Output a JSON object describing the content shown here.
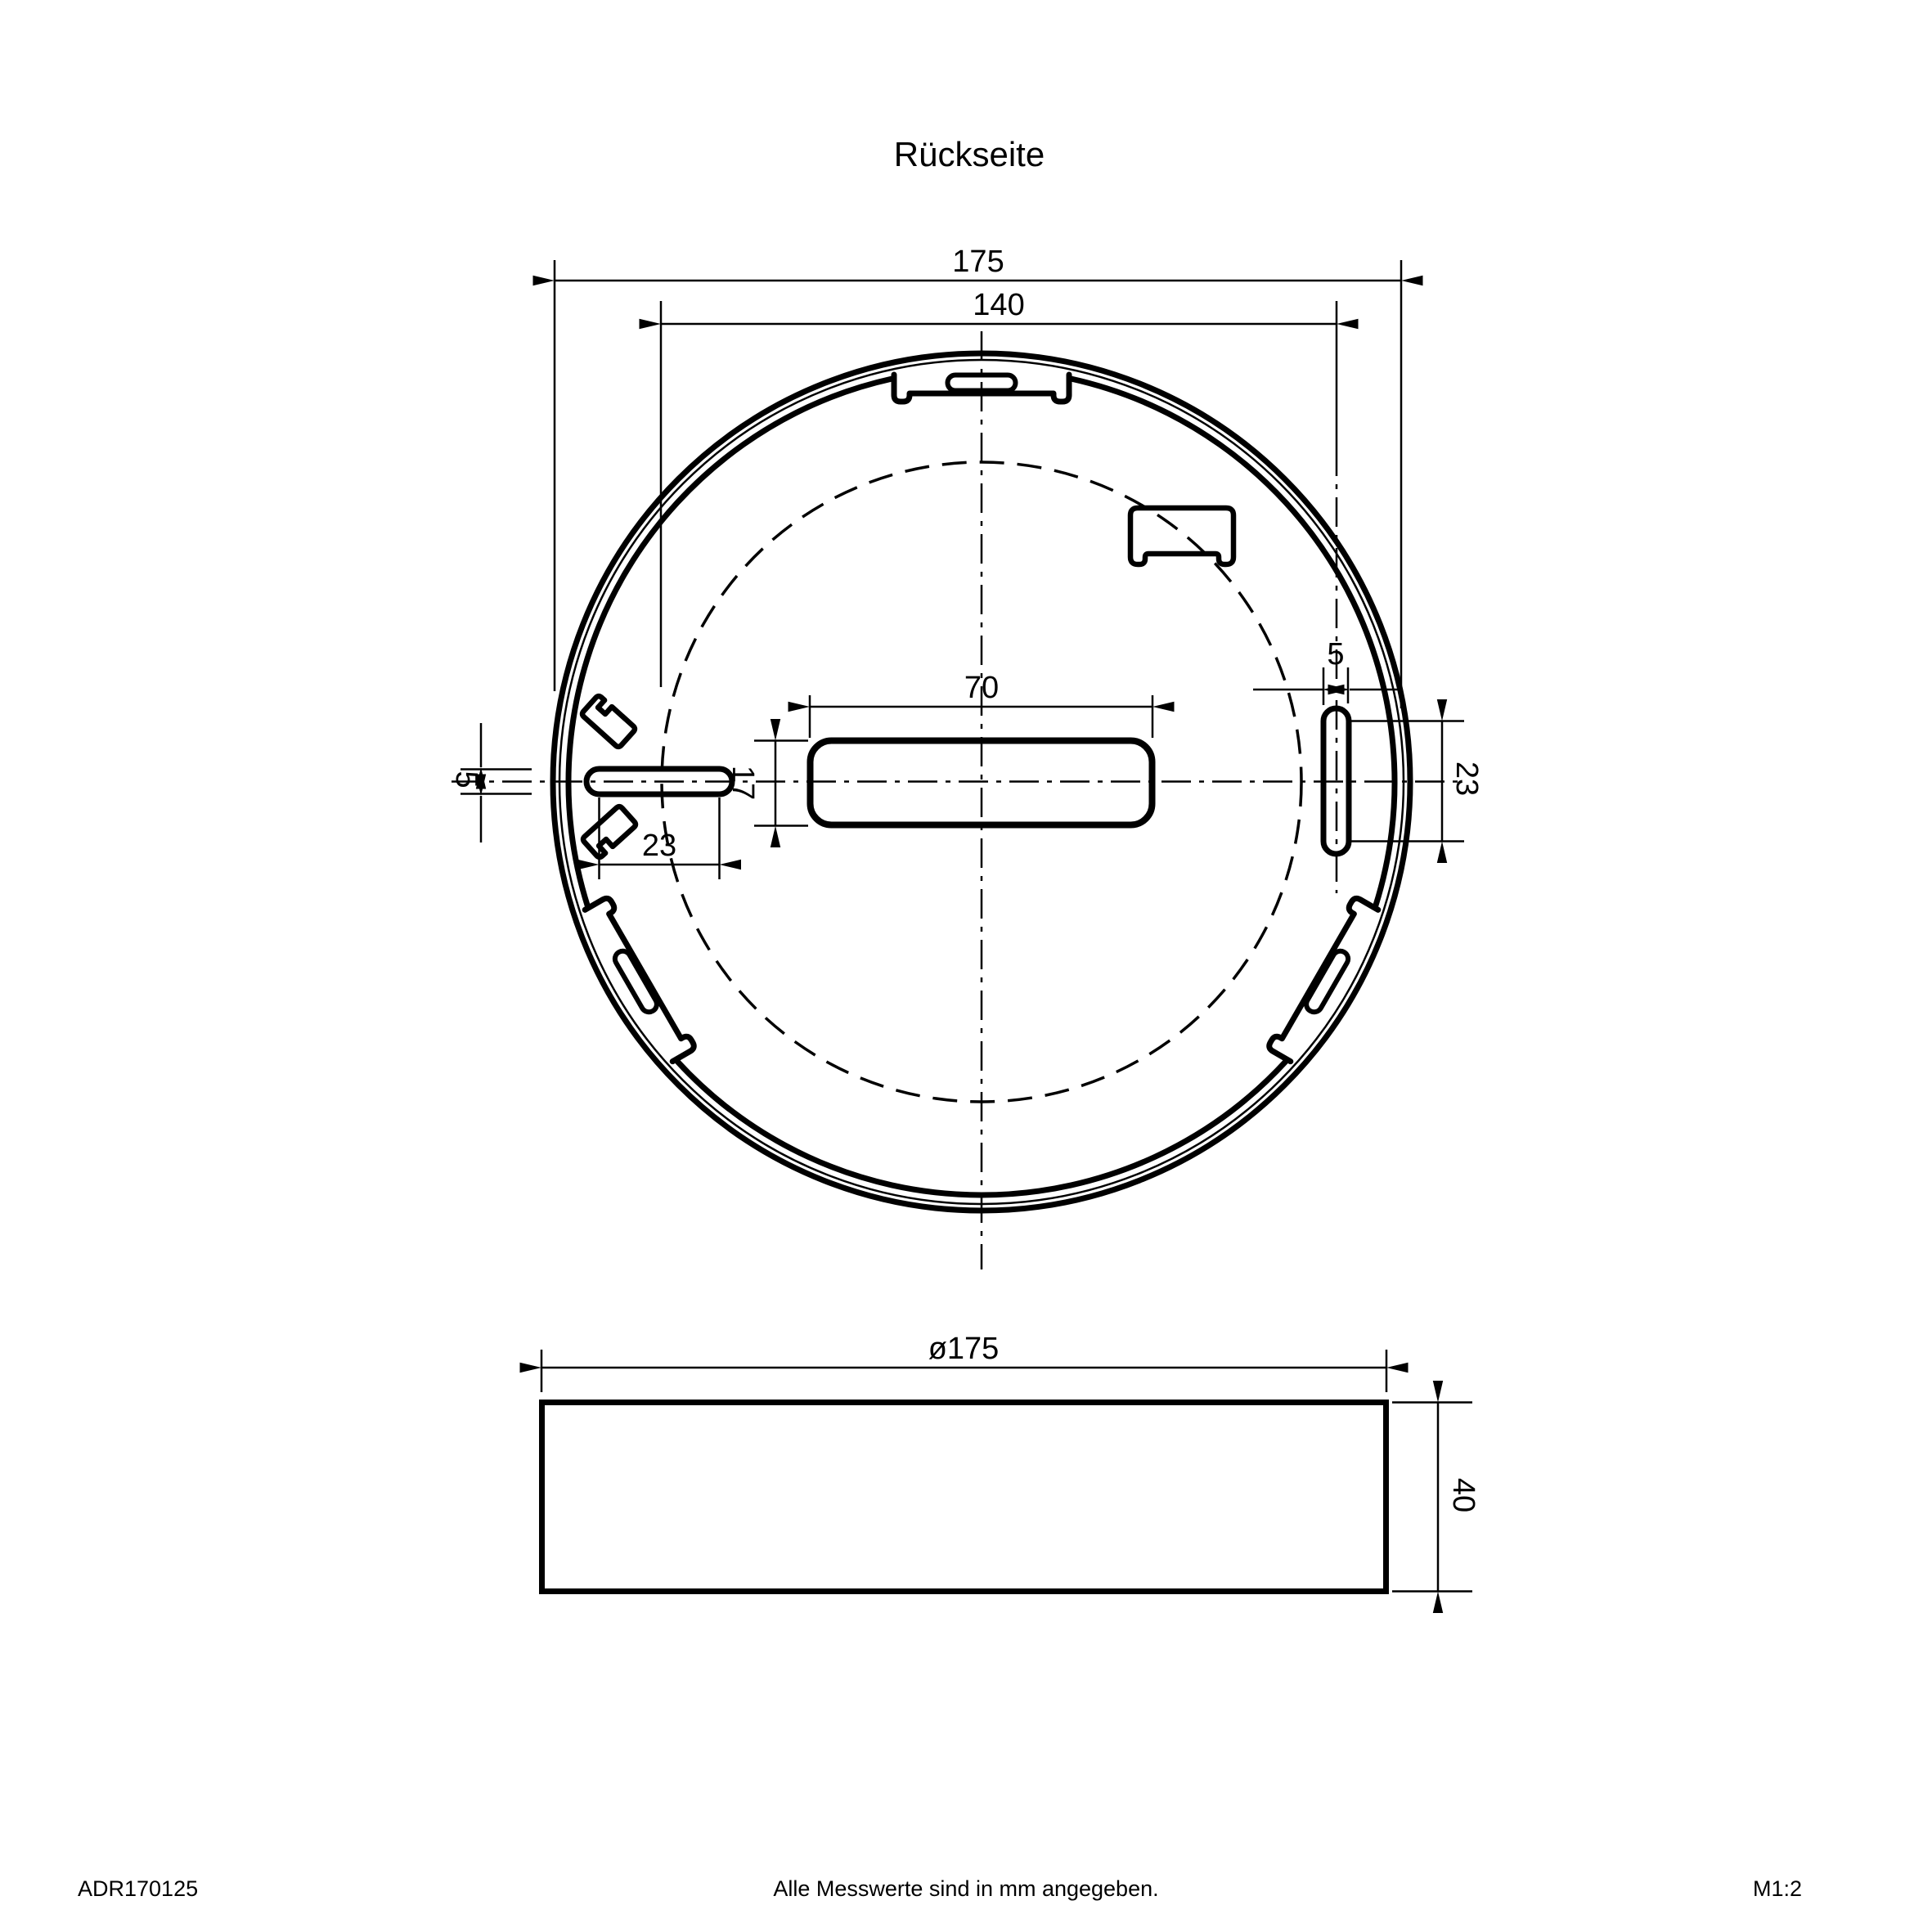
{
  "title": "Rückseite",
  "top_view": {
    "dim_overall_diameter": "175",
    "dim_mounting_circle": "140",
    "dim_center_slot_length": "70",
    "dim_center_slot_height": "17",
    "dim_left_slot_height": "5",
    "dim_left_slot_length": "23",
    "dim_right_slot_width": "5",
    "dim_right_slot_length": "23"
  },
  "side_view": {
    "dim_diameter": "ø175",
    "dim_height": "40"
  },
  "footer": {
    "article_number": "ADR170125",
    "note": "Alle Messwerte sind in mm angegeben.",
    "scale": "M1:2"
  },
  "colors": {
    "line": "#000000",
    "background": "#ffffff"
  }
}
